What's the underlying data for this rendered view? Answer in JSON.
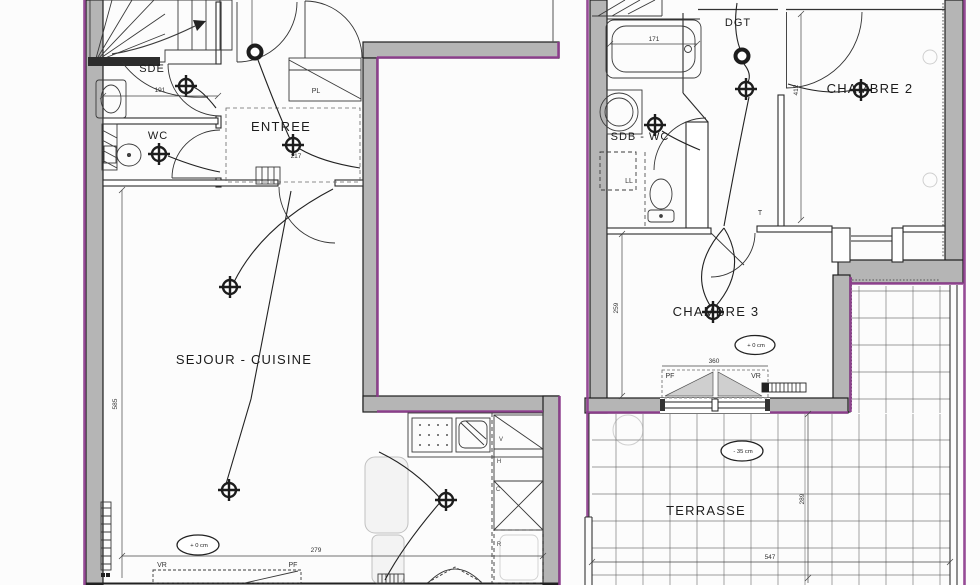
{
  "plans": {
    "left": {
      "sde": "SDE",
      "wc": "WC",
      "entree": "ENTREE",
      "sejour": "SEJOUR - CUISINE",
      "pl": "PL",
      "vr": "VR",
      "pf": "PF",
      "level": "+ 0 cm",
      "d191": "191",
      "d217": "217",
      "d279": "279",
      "d585": "585",
      "v": "V",
      "h": "H",
      "c": "C",
      "r": "R"
    },
    "right": {
      "dgt": "DGT",
      "sdbwc": "SDB - WC",
      "ch2": "CHAMBRE 2",
      "ch3": "CHAMBRE 3",
      "terrasse": "TERRASSE",
      "ll": "LL",
      "pf": "PF",
      "vr": "VR",
      "t": "T",
      "level_ch3": "+ 0 cm",
      "level_ter": "- 35 cm",
      "d171": "171",
      "d412": "412",
      "d259": "259",
      "d360": "360",
      "d289": "289",
      "d547": "547"
    }
  },
  "colors": {
    "wall": "#b5b5b5",
    "boundary": "#8e3d8e",
    "ink": "#2a2a2a"
  }
}
